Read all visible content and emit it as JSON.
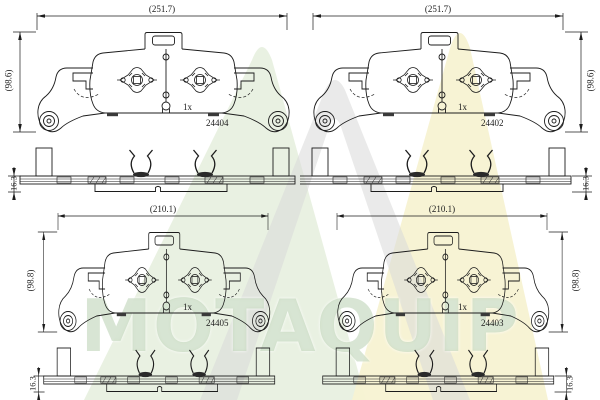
{
  "watermark": {
    "text": "MOTAQUIP",
    "green": "#e7efdf",
    "yellow": "#f7f2d2",
    "grey": "#d8d8d8",
    "text_color": "#b2cbaa"
  },
  "drawing": {
    "line_color": "#1c1c1c",
    "background": "#ffffff"
  },
  "quadrants": [
    {
      "position": "top-left",
      "width_label": "(251.7)",
      "height_label": "(98.6)",
      "thickness_label": "16.3",
      "qty_label": "1x",
      "part_number": "24404"
    },
    {
      "position": "top-right",
      "width_label": "(251.7)",
      "height_label": "(98.6)",
      "thickness_label": "16.3",
      "qty_label": "1x",
      "part_number": "24402"
    },
    {
      "position": "bottom-left",
      "width_label": "(210.1)",
      "height_label": "(98.8)",
      "thickness_label": "16.3",
      "qty_label": "1x",
      "part_number": "24405"
    },
    {
      "position": "bottom-right",
      "width_label": "(210.1)",
      "height_label": "(98.8)",
      "thickness_label": "16.3",
      "qty_label": "1x",
      "part_number": "24403"
    }
  ]
}
